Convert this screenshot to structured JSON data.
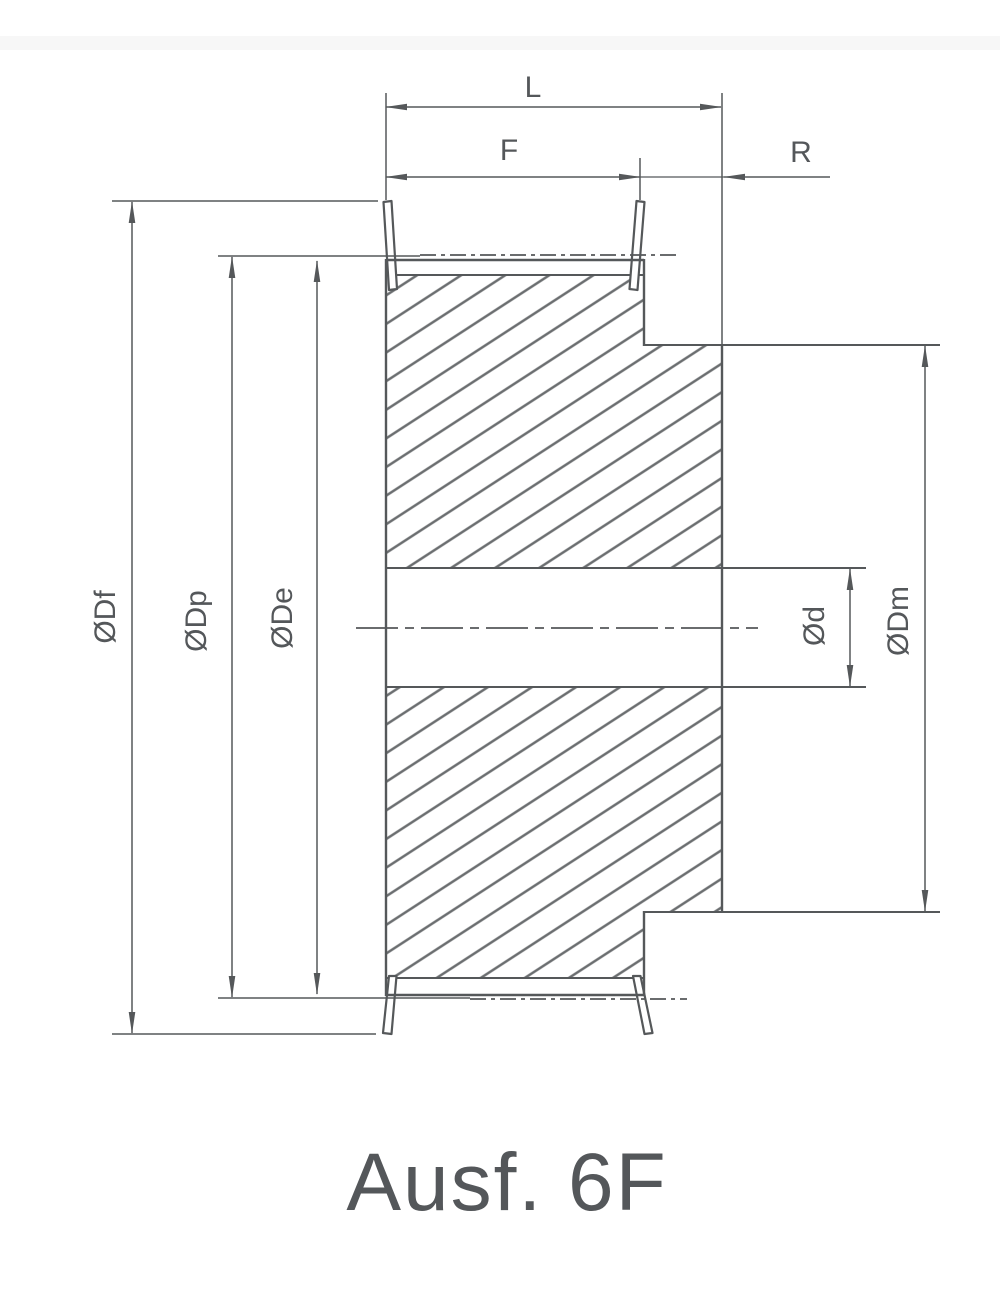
{
  "drawing": {
    "caption": "Ausf. 6F",
    "labels": {
      "overall_width": "L",
      "face_width": "F",
      "hub_projection": "R",
      "flange_diameter": "ØDf",
      "pitch_diameter": "ØDp",
      "outside_diameter": "ØDe",
      "bore_diameter": "Ød",
      "hub_diameter": "ØDm"
    },
    "colors": {
      "line": "#55585a",
      "hatch": "#6b6e70",
      "text": "#54575a",
      "background": "#ffffff"
    }
  }
}
